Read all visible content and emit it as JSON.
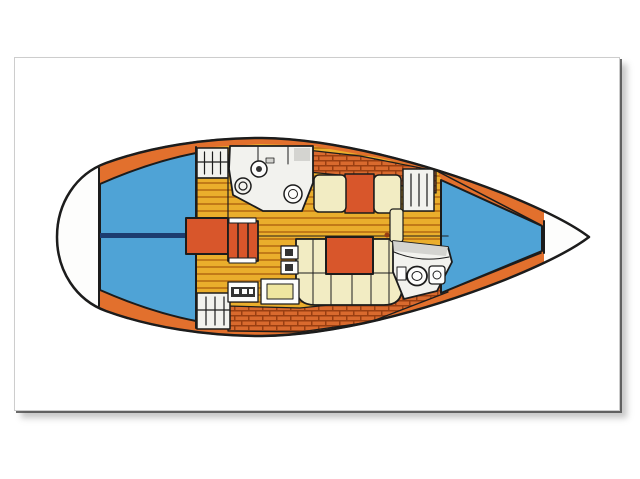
{
  "image_kind": "sailboat-interior-layout-plan",
  "orientation": "bow-right",
  "colors": {
    "background": "#ffffff",
    "white": "#fdfdfc",
    "outline": "#1c1c1c",
    "deck_orange": "#e2702d",
    "brick_orange": "#d96a2e",
    "brick_line": "#993f12",
    "berth_blue": "#4fa3d6",
    "navy": "#1c3c70",
    "floor_yellow": "#eaae2c",
    "floor_stripe": "#c17a18",
    "cushion_cream": "#f2ecc3",
    "furniture_red": "#d8562b",
    "fixture_white": "#f2f2ee",
    "fixture_gray": "#d4d4d0",
    "detail_dark": "#333333",
    "chart_inset_yellow": "#efe6a0"
  },
  "regions": [
    {
      "id": "transom-swim-platform"
    },
    {
      "id": "aft-cabin-berth"
    },
    {
      "id": "centerline"
    },
    {
      "id": "side-decks"
    },
    {
      "id": "hanging-locker-port-aft"
    },
    {
      "id": "hanging-locker-starboard-aft"
    },
    {
      "id": "companionway-steps"
    },
    {
      "id": "galley-sink-stove"
    },
    {
      "id": "saloon-sole"
    },
    {
      "id": "saloon-settee"
    },
    {
      "id": "saloon-table"
    },
    {
      "id": "dinette-settee"
    },
    {
      "id": "nav-instruments"
    },
    {
      "id": "chart-table"
    },
    {
      "id": "heads-toilet-sink"
    },
    {
      "id": "forward-cabin-door"
    },
    {
      "id": "v-berth"
    },
    {
      "id": "anchor-locker"
    }
  ]
}
